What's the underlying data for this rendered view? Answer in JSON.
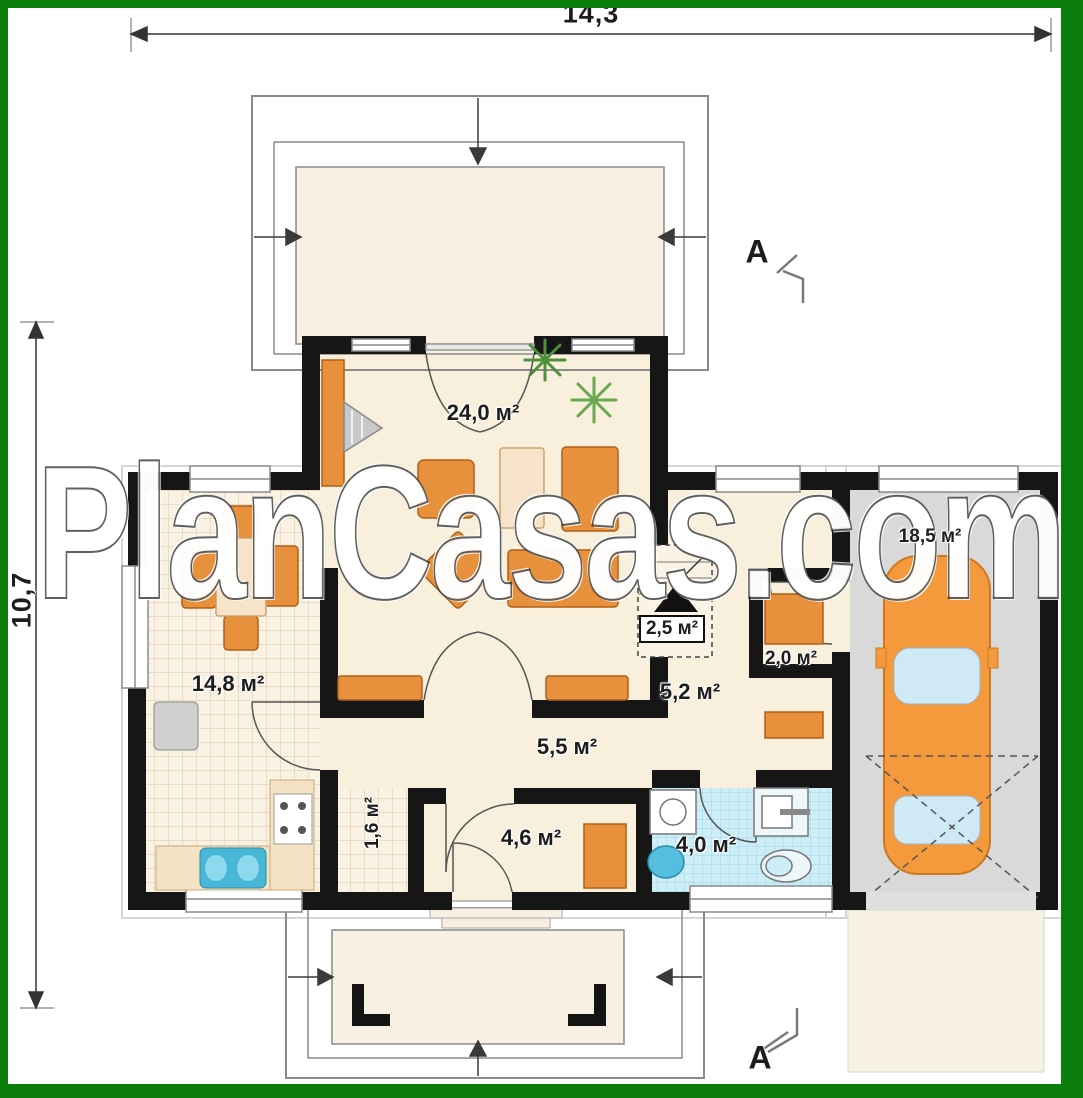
{
  "watermark": "PlanCasas.com",
  "dimensions": {
    "width": "14,3",
    "height": "10,7"
  },
  "section": {
    "top": "A",
    "bottom": "A"
  },
  "rooms": {
    "living": {
      "label": "24,0 м²"
    },
    "dining": {
      "label": "14,8 м²"
    },
    "stairs": {
      "label": "2,5 м²"
    },
    "hall": {
      "label": "5,5 м²"
    },
    "corridor": {
      "label": "5,2 м²"
    },
    "closet": {
      "label": "2,0 м²"
    },
    "pantry": {
      "label": "1,6 м²"
    },
    "vestibule": {
      "label": "4,6 м²"
    },
    "bathroom": {
      "label": "4,0 м²"
    },
    "garage": {
      "label": "18,5 м²"
    }
  },
  "colors": {
    "frame": "#0a7d0a",
    "wall": "#161616",
    "floor": "#f8efdd",
    "furniture": "#e8913d",
    "bath_tile": "#cdeef7",
    "garage_floor": "#d9d9d9"
  }
}
